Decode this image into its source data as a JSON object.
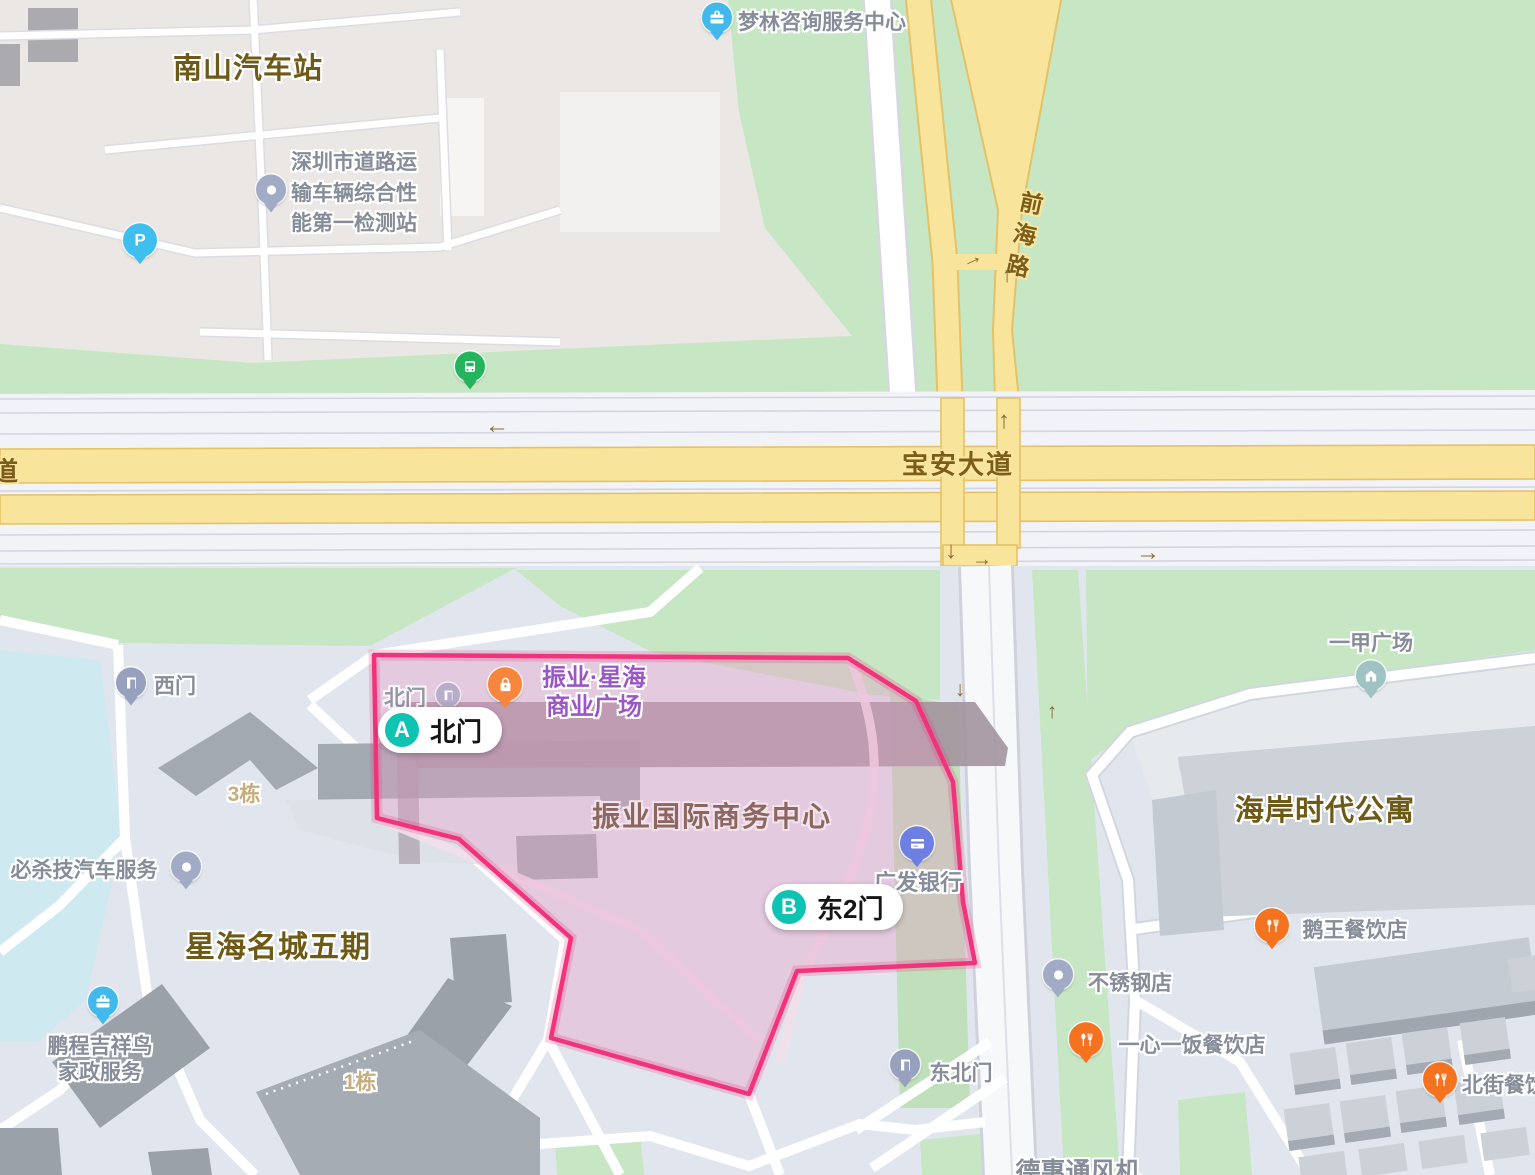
{
  "map": {
    "area_labels": {
      "nanshan_bus_station": "南山汽车站",
      "xinghai_mingcheng_phase5": "星海名城五期",
      "haian_shidai_apartment": "海岸时代公寓",
      "zhenye_intl_business_center": "振业国际商务中心"
    },
    "road_labels": {
      "baoan_avenue": "宝安大道",
      "qianhai_road": "前海路",
      "left_edge_partial": "道"
    },
    "building_numbers": {
      "building_3": "3栋",
      "building_1": "1栋"
    },
    "gate_markers": [
      {
        "letter": "A",
        "label": "北门"
      },
      {
        "letter": "B",
        "label": "东2门"
      }
    ],
    "pois": {
      "inspection_station": {
        "lines": [
          "深圳市道路运",
          "输车辆综合性",
          "能第一检测站"
        ]
      },
      "menglin_consulting": {
        "label": "梦林咨询服务中心"
      },
      "zhenye_xinghai_plaza": {
        "lines": [
          "振业·星海",
          "商业广场"
        ]
      },
      "north_gate": {
        "label": "北门"
      },
      "west_gate": {
        "label": "西门"
      },
      "northeast_gate": {
        "label": "东北门"
      },
      "guangfa_bank": {
        "label": "广发银行"
      },
      "bishaji_auto_service": {
        "label": "必杀技汽车服务"
      },
      "pengcheng_housekeeping": {
        "lines": [
          "鹏程吉祥鸟",
          "家政服务"
        ]
      },
      "stainless_steel_shop": {
        "label": "不锈钢店"
      },
      "goose_king_restaurant": {
        "label": "鹅王餐饮店"
      },
      "yixin_yifan_restaurant": {
        "label": "一心一饭餐饮店"
      },
      "yijia_plaza": {
        "label": "一甲广场"
      },
      "beijie_restaurant": {
        "label": "北街餐饮"
      },
      "dehui_fan": {
        "label": "德惠通风机"
      }
    },
    "icons": {
      "parking_glyph": "P"
    },
    "arrows": [
      {
        "glyph": "←"
      },
      {
        "glyph": "↑"
      },
      {
        "glyph": "↓"
      },
      {
        "glyph": "→"
      },
      {
        "glyph": "→"
      },
      {
        "glyph": "→"
      },
      {
        "glyph": "↑"
      },
      {
        "glyph": "↓"
      },
      {
        "glyph": "↑"
      }
    ],
    "colors": {
      "highlight_border": "#f0337a",
      "gate_marker_teal": "#0fc3b3",
      "road_yellow": "#f9e49c",
      "green_area": "#c7e6c4"
    }
  }
}
